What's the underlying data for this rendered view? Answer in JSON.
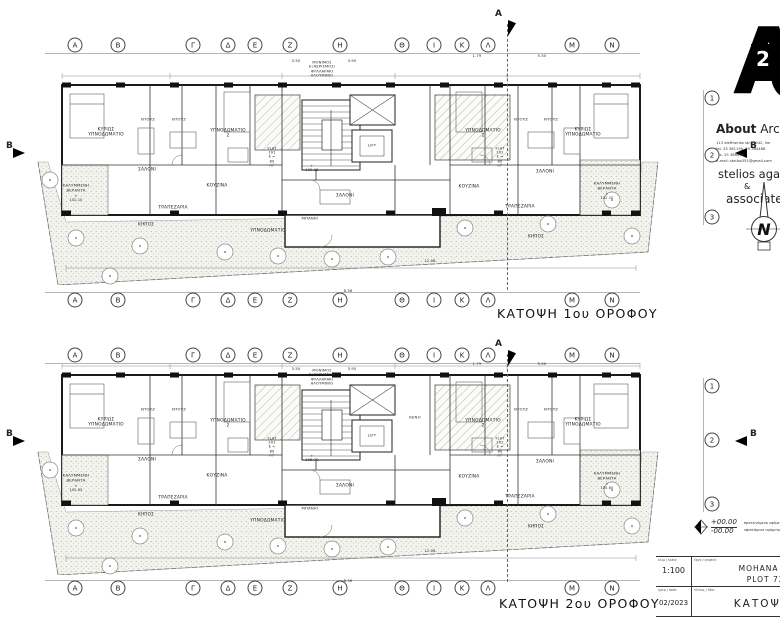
{
  "grid": {
    "letters": [
      "Α",
      "Β",
      "Γ",
      "Δ",
      "Ε",
      "Ζ",
      "Η",
      "Θ",
      "Ι",
      "Κ",
      "Λ",
      "Μ",
      "Ν"
    ],
    "letter_xs": [
      75,
      118,
      193,
      228,
      255,
      290,
      340,
      402,
      434,
      462,
      488,
      572,
      612
    ],
    "letter_row_ys": [
      45,
      300,
      355,
      588
    ],
    "numbers": [
      "1",
      "2",
      "3"
    ],
    "number_x": 712,
    "number_row_ys": [
      [
        98,
        155,
        217
      ],
      [
        386,
        440,
        504
      ]
    ],
    "section_a": "Α",
    "section_b": "Β"
  },
  "plans": [
    {
      "title": "ΚΑΤΟΨΗ 1ου ΟΡΟΦΟΥ",
      "labels": [
        {
          "t": "ΜΟΝΙΜΟΣ ΕΞΑΕΡΙΣΜΟΣ/\nΦΥΛΛΑΡΑΚΙ ΑΛΟΥΜΙΝΙΟ",
          "x": 322,
          "y": 69,
          "fs": 3.6
        },
        {
          "t": "3.50",
          "x": 296,
          "y": 61,
          "fs": 3.6
        },
        {
          "t": "3.95",
          "x": 352,
          "y": 61,
          "fs": 3.6
        },
        {
          "t": "1.79",
          "x": 477,
          "y": 56,
          "fs": 3.6
        },
        {
          "t": "5.50",
          "x": 542,
          "y": 56,
          "fs": 3.6
        },
        {
          "t": "ΚΥΡΙΩΣ\nΥΠΝΟΔΩΜΑΤΙΟ",
          "x": 106,
          "y": 133
        },
        {
          "t": "ΝΤΟΥΖ",
          "x": 148,
          "y": 120,
          "fs": 3.8
        },
        {
          "t": "ΝΤΟΥΖ",
          "x": 179,
          "y": 120,
          "fs": 3.8
        },
        {
          "t": "ΥΠΝΟΔΩΜΑΤΙΟ 2",
          "x": 228,
          "y": 134
        },
        {
          "t": "ΥΠΝΟΔΩΜΑΤΙΟ 2",
          "x": 483,
          "y": 134
        },
        {
          "t": "ΝΤΟΥΖ",
          "x": 521,
          "y": 120,
          "fs": 3.8
        },
        {
          "t": "ΝΤΟΥΖ",
          "x": 551,
          "y": 120,
          "fs": 3.8
        },
        {
          "t": "ΚΥΡΙΩΣ\nΥΠΝΟΔΩΜΑΤΙΟ",
          "x": 583,
          "y": 133
        },
        {
          "t": "ΣΑΛΟΝΙ",
          "x": 147,
          "y": 170
        },
        {
          "t": "ΚΟΥΖΙΝΑ",
          "x": 217,
          "y": 186
        },
        {
          "t": "ΤΡΑΠΕΖΑΡΙΑ",
          "x": 173,
          "y": 208
        },
        {
          "t": "ΚΑΛΥΜΜΕΝΗ\nΒΕΡΑΝΤΑ",
          "x": 76,
          "y": 188,
          "fs": 3.8
        },
        {
          "t": "+ 102.10",
          "x": 76,
          "y": 198,
          "fs": 3.4
        },
        {
          "t": "ΚΗΠΟΣ",
          "x": 146,
          "y": 224,
          "fs": 4.2
        },
        {
          "t": "FLAT 101\nΕ = 80 m²",
          "x": 272,
          "y": 157,
          "fs": 3.5
        },
        {
          "t": "+ 102.15",
          "x": 312,
          "y": 168,
          "fs": 3.5
        },
        {
          "t": "FLAT 102\nΕ = 80 m²",
          "x": 500,
          "y": 157,
          "fs": 3.5
        },
        {
          "t": "ΣΑΛΟΝΙ",
          "x": 345,
          "y": 196
        },
        {
          "t": "ΥΠΝΟΔΩΜΑΤΙΟ",
          "x": 268,
          "y": 231
        },
        {
          "t": "ΜΠΑΝΙΟ",
          "x": 310,
          "y": 219,
          "fs": 3.8
        },
        {
          "t": "ΚΟΥΖΙΝΑ",
          "x": 469,
          "y": 187
        },
        {
          "t": "ΣΑΛΟΝΙ",
          "x": 545,
          "y": 172
        },
        {
          "t": "ΤΡΑΠΕΖΑΡΙΑ",
          "x": 520,
          "y": 207
        },
        {
          "t": "ΚΑΛΥΜΜΕΝΗ\nΒΕΡΑΝΤΑ",
          "x": 607,
          "y": 186,
          "fs": 3.8
        },
        {
          "t": "+ 102.10",
          "x": 607,
          "y": 196,
          "fs": 3.4
        },
        {
          "t": "ΚΗΠΟΣ",
          "x": 536,
          "y": 236,
          "fs": 4.2
        },
        {
          "t": "LIFT",
          "x": 372,
          "y": 146,
          "fs": 3.8
        },
        {
          "t": "8.36",
          "x": 348,
          "y": 291,
          "fs": 3.6
        },
        {
          "t": "12.98",
          "x": 430,
          "y": 261,
          "fs": 3.6
        }
      ]
    },
    {
      "title": "ΚΑΤΟΨΗ 2ου ΟΡΟΦΟΥ",
      "labels": [
        {
          "t": "ΜΟΝΙΜΟΣ ΕΞΑΕΡΙΣΜΟΣ/\nΦΥΛΛΑΡΑΚΙ ΑΛΟΥΜΙΝΙΟ",
          "x": 322,
          "y": 377,
          "fs": 3.6
        },
        {
          "t": "3.50",
          "x": 296,
          "y": 369,
          "fs": 3.6
        },
        {
          "t": "3.95",
          "x": 352,
          "y": 369,
          "fs": 3.6
        },
        {
          "t": "1.79",
          "x": 477,
          "y": 364,
          "fs": 3.6
        },
        {
          "t": "5.50",
          "x": 542,
          "y": 364,
          "fs": 3.6
        },
        {
          "t": "ΚΥΡΙΩΣ\nΥΠΝΟΔΩΜΑΤΙΟ",
          "x": 106,
          "y": 423
        },
        {
          "t": "ΝΤΟΥΖ",
          "x": 148,
          "y": 410,
          "fs": 3.8
        },
        {
          "t": "ΝΤΟΥΖ",
          "x": 179,
          "y": 410,
          "fs": 3.8
        },
        {
          "t": "ΥΠΝΟΔΩΜΑΤΙΟ 2",
          "x": 228,
          "y": 424
        },
        {
          "t": "ΥΠΝΟΔΩΜΑΤΙΟ 2",
          "x": 483,
          "y": 424
        },
        {
          "t": "ΝΤΟΥΖ",
          "x": 521,
          "y": 410,
          "fs": 3.8
        },
        {
          "t": "ΝΤΟΥΖ",
          "x": 551,
          "y": 410,
          "fs": 3.8
        },
        {
          "t": "ΚΥΡΙΩΣ\nΥΠΝΟΔΩΜΑΤΙΟ",
          "x": 583,
          "y": 423
        },
        {
          "t": "ΣΑΛΟΝΙ",
          "x": 147,
          "y": 460
        },
        {
          "t": "ΚΟΥΖΙΝΑ",
          "x": 217,
          "y": 476
        },
        {
          "t": "ΤΡΑΠΕΖΑΡΙΑ",
          "x": 173,
          "y": 498
        },
        {
          "t": "ΚΑΛΥΜΜΕΝΗ\nΒΕΡΑΝΤΑ",
          "x": 76,
          "y": 478,
          "fs": 3.8
        },
        {
          "t": "+ 105.65",
          "x": 76,
          "y": 488,
          "fs": 3.4
        },
        {
          "t": "ΚΗΠΟΣ",
          "x": 146,
          "y": 514,
          "fs": 4.2
        },
        {
          "t": "FLAT 201\nΕ = 80 m²",
          "x": 272,
          "y": 447,
          "fs": 3.5
        },
        {
          "t": "+ 105.70",
          "x": 312,
          "y": 458,
          "fs": 3.5
        },
        {
          "t": "FLAT 202\nΕ = 80 m²",
          "x": 500,
          "y": 447,
          "fs": 3.5
        },
        {
          "t": "ΣΑΛΟΝΙ",
          "x": 345,
          "y": 486
        },
        {
          "t": "ΥΠΝΟΔΩΜΑΤΙΟ",
          "x": 268,
          "y": 521
        },
        {
          "t": "ΜΠΑΝΙΟ",
          "x": 310,
          "y": 509,
          "fs": 3.8
        },
        {
          "t": "ΚΟΥΖΙΝΑ",
          "x": 469,
          "y": 477
        },
        {
          "t": "ΣΑΛΟΝΙ",
          "x": 545,
          "y": 462
        },
        {
          "t": "ΤΡΑΠΕΖΑΡΙΑ",
          "x": 520,
          "y": 497
        },
        {
          "t": "ΚΑΛΥΜΜΕΝΗ\nΒΕΡΑΝΤΑ",
          "x": 607,
          "y": 476,
          "fs": 3.8
        },
        {
          "t": "+ 105.65",
          "x": 607,
          "y": 486,
          "fs": 3.4
        },
        {
          "t": "ΚΗΠΟΣ",
          "x": 536,
          "y": 526,
          "fs": 4.2
        },
        {
          "t": "ΚΕΝΟ",
          "x": 415,
          "y": 418,
          "fs": 3.8
        },
        {
          "t": "LIFT",
          "x": 372,
          "y": 436,
          "fs": 3.8
        },
        {
          "t": "8.36",
          "x": 348,
          "y": 581,
          "fs": 3.6
        },
        {
          "t": "12.98",
          "x": 430,
          "y": 551,
          "fs": 3.6
        }
      ]
    }
  ],
  "panel": {
    "logo_text": "A",
    "logo_num": "2",
    "firm_bold": "About",
    "firm_rest": " Archi",
    "address": "113 eleftherias str., 3042, lim",
    "tel": "tel. 25 361195, 25 364488",
    "fax": "fax. 25 368699",
    "email": "e-mail: stelios351@gmail.com",
    "principal": "stelios agathok",
    "amp": "&",
    "associates": "associates",
    "north": "N"
  },
  "level_legend": {
    "plus": "+00.00",
    "minus": "-00.00",
    "label_plus": "προτεινόμενο υψόμετρο",
    "label_minus": "υφιστάμενο υψόμετρο"
  },
  "title_block": {
    "scale_label": "κλιμ / scale:",
    "scale": "1:100",
    "project_label": "έργο / project:",
    "project1": "MOHANA  LTD",
    "project2": "PLOT 725",
    "date_label": "ημερ / date:",
    "date": "02/2023",
    "title_label": "τίτλος / title:",
    "title": "ΚΑΤΟΨΕΙΣ"
  }
}
